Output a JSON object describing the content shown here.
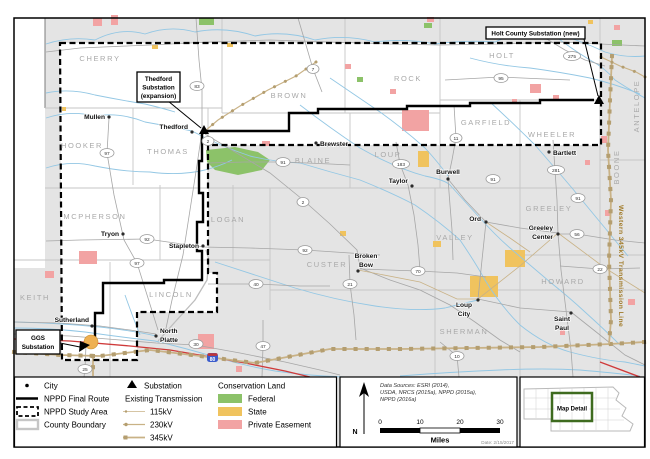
{
  "map": {
    "counties": [
      "CHERRY",
      "BROWN",
      "ROCK",
      "HOLT",
      "GARFIELD",
      "WHEELER",
      "ANTELOPE",
      "BOONE",
      "HOOKER",
      "THOMAS",
      "BLAINE",
      "LOUP",
      "MCPHERSON",
      "LOGAN",
      "CUSTER",
      "VALLEY",
      "GREELEY",
      "KEITH",
      "LINCOLN",
      "SHERMAN",
      "HOWARD"
    ],
    "cities": [
      "Mullen",
      "Thedford",
      "Brewster",
      "Taylor",
      "Burwell",
      "Bartlett",
      "Ord",
      "Greeley",
      "Center",
      "Broken",
      "Bow",
      "Loup",
      "City",
      "Saint",
      "Paul",
      "Tryon",
      "Stapleton",
      "Sutherland",
      "North",
      "Platte"
    ],
    "shields": [
      "83",
      "7",
      "97",
      "2",
      "91",
      "2",
      "95",
      "275",
      "11",
      "183",
      "281",
      "91",
      "91",
      "92",
      "97",
      "40",
      "21",
      "70",
      "22",
      "56",
      "10",
      "92",
      "30",
      "47",
      "25"
    ],
    "interstate": "80",
    "callouts": {
      "thedford": [
        "Thedford",
        "Substation",
        "(expansion)"
      ],
      "holt": "Holt County Substation (new)",
      "ggs": [
        "GGS",
        "Substation"
      ]
    },
    "annotations": {
      "western_line": "Western 345kV Transmission Line"
    }
  },
  "legend": {
    "city": "City",
    "final_route": "NPPD Final Route",
    "study_area": "NPPD Study Area",
    "county_boundary": "County Boundary",
    "substation": "Substation",
    "existing_transmission": "Existing Transmission",
    "kv115": "115kV",
    "kv230": "230kV",
    "kv345": "345kV",
    "conservation": "Conservation Land",
    "federal": "Federal",
    "state": "State",
    "private": "Private Easement"
  },
  "panel": {
    "north": "N",
    "sources": [
      "Data Sources: ESRI (2014),",
      "USDA, NRCS (2015a), NPPD (2015a),",
      "NPPD (2016a)"
    ],
    "date": "Date: 2/15/2017",
    "scale_ticks": [
      "0",
      "10",
      "20",
      "30"
    ],
    "scale_unit": "Miles"
  },
  "inset": {
    "label": "Map Detail"
  },
  "colors": {
    "federal": "#8cc269",
    "state": "#f0c35e",
    "private_easement": "#f2a3a3",
    "transmission": "#c9b286",
    "water": "#93c7e4",
    "route": "#000000",
    "interstate_red": "#cf3a3a",
    "western_label": "#a07a28"
  }
}
